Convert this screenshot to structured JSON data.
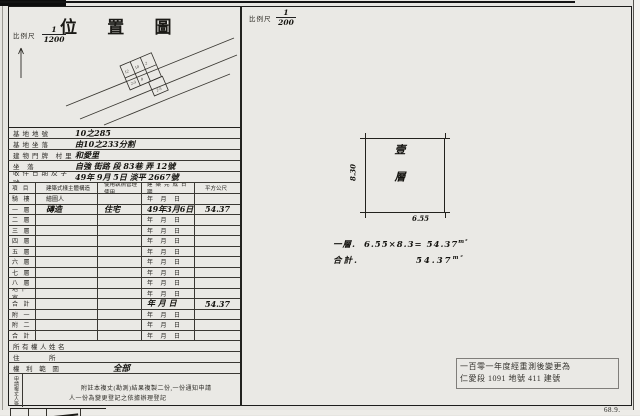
{
  "left_panel": {
    "title": "位 置 圖",
    "scale_label": "比例尺",
    "scale_num": "1",
    "scale_den": "1200",
    "info_rows": [
      {
        "label": "基地地號",
        "value": "10之285"
      },
      {
        "label": "基地坐落",
        "value": "由10之233分割"
      },
      {
        "label": "建物門牌 村里",
        "value": "和愛里"
      },
      {
        "label": "坐 落",
        "value": "自強 街路 段 83巷 弄 12號"
      },
      {
        "label": "收件日期及字號",
        "value": "49年 9月 5日 淡平 2667號"
      }
    ],
    "floor_table": {
      "headers": [
        "項 目",
        "建築式樣主體構造",
        "使用執照管理使用",
        "建築完成日期",
        "平方公尺"
      ],
      "rows": [
        {
          "label": "騎 樓",
          "structure": "繪圖人",
          "use": "",
          "date": "年 月 日",
          "area": "",
          "hand": false
        },
        {
          "label": "一 層",
          "structure": "磚造",
          "use": "住宅",
          "date": "49年3月6日",
          "area": "54.37",
          "hand": true
        },
        {
          "label": "二 層",
          "structure": "",
          "use": "",
          "date": "年 月 日",
          "area": "",
          "hand": false
        },
        {
          "label": "三 層",
          "structure": "",
          "use": "",
          "date": "年 月 日",
          "area": "",
          "hand": false
        },
        {
          "label": "四 層",
          "structure": "",
          "use": "",
          "date": "年 月 日",
          "area": "",
          "hand": false
        },
        {
          "label": "五 層",
          "structure": "",
          "use": "",
          "date": "年 月 日",
          "area": "",
          "hand": false
        },
        {
          "label": "六 層",
          "structure": "",
          "use": "",
          "date": "年 月 日",
          "area": "",
          "hand": false
        },
        {
          "label": "七 層",
          "structure": "",
          "use": "",
          "date": "年 月 日",
          "area": "",
          "hand": false
        },
        {
          "label": "八 層",
          "structure": "",
          "use": "",
          "date": "年 月 日",
          "area": "",
          "hand": false
        },
        {
          "label": "地下室",
          "structure": "",
          "use": "",
          "date": "年 月 日",
          "area": "",
          "hand": false
        },
        {
          "label": "合 計",
          "structure": "",
          "use": "",
          "date": "年 月 日",
          "area": "54.37",
          "hand": true
        },
        {
          "label": "附 一",
          "structure": "",
          "use": "",
          "date": "年 月 日",
          "area": "",
          "hand": false
        },
        {
          "label": "附 二",
          "structure": "",
          "use": "",
          "date": "年 月 日",
          "area": "",
          "hand": false
        },
        {
          "label": "合 計",
          "structure": "",
          "use": "",
          "date": "年 月 日",
          "area": "",
          "hand": false
        }
      ]
    },
    "owner_rows": [
      {
        "label": "所有權人姓名",
        "value": "",
        "hand": false
      },
      {
        "label": "住　　　所",
        "value": "",
        "hand": false
      },
      {
        "label": "權 利 範 圍",
        "value": "全部",
        "hand": true
      }
    ],
    "note": {
      "vertical_label": "申請複丈人簽章",
      "line1": "附註本複丈(勘測)結果複製二份,一份通知申請",
      "line2": "人一份為變更登記之依據辦理登記"
    }
  },
  "right_panel": {
    "scale_label": "比例尺",
    "scale_num": "1",
    "scale_den": "200",
    "plan": {
      "floor_label": "壹層",
      "width_dim": "6.55",
      "height_dim": "8.30"
    },
    "calc": [
      {
        "label": "一層.",
        "expr": "6.55×8.3=",
        "value": "54.37",
        "unit": "m²"
      },
      {
        "label": "合計.",
        "expr": "",
        "value": "54.37",
        "unit": "m²"
      }
    ],
    "stamp": {
      "line1": "一百零一年度經重測後變更為",
      "line2": "仁愛段 1091 地號 411 建號"
    }
  },
  "footer": {
    "form_code": "68.9."
  }
}
